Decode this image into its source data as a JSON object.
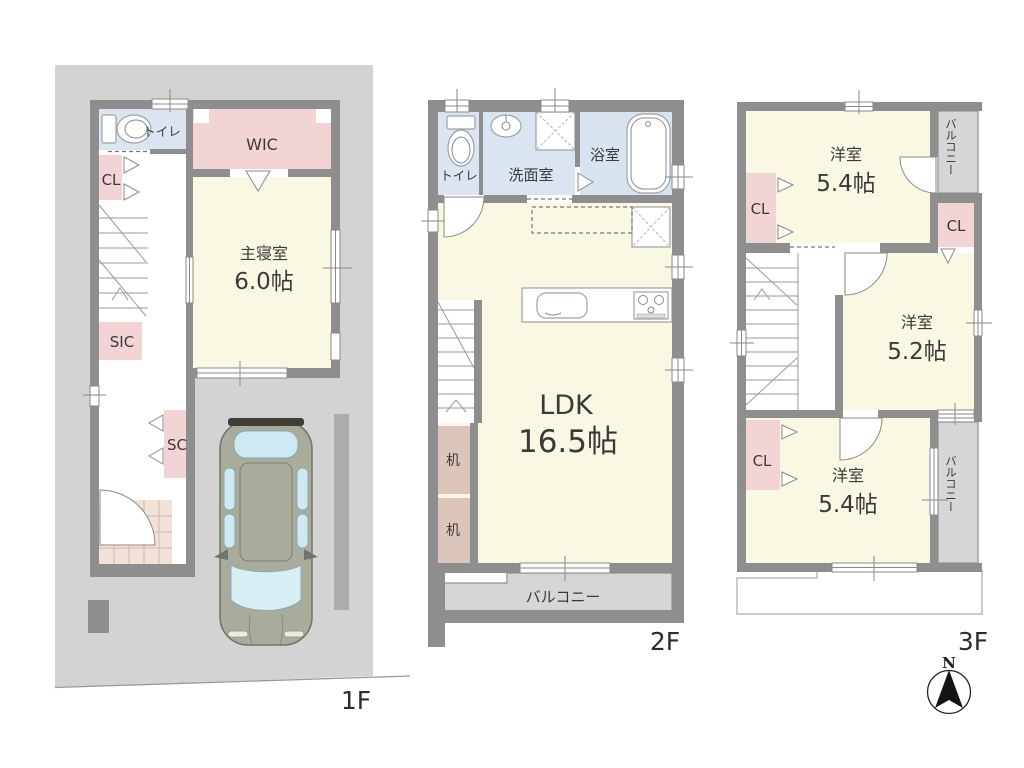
{
  "f1": {
    "floor_label": "1F",
    "toilet_label": "トイレ",
    "wic_label": "WIC",
    "cl_label": "CL",
    "bedroom_name": "主寝室",
    "bedroom_size": "6.0帖",
    "sic_label": "SIC",
    "sc_label": "SC"
  },
  "f2": {
    "floor_label": "2F",
    "toilet_label": "トイレ",
    "washroom_label": "洗面室",
    "bath_label": "浴室",
    "ldk_name": "LDK",
    "ldk_size": "16.5帖",
    "desk1_label": "机",
    "desk2_label": "机",
    "balcony_label": "バルコニー"
  },
  "f3": {
    "floor_label": "3F",
    "room_top_name": "洋室",
    "room_top_size": "5.4帖",
    "cl_top_left_label": "CL",
    "cl_top_right_label": "CL",
    "cl_bottom_left_label": "CL",
    "room_mid_name": "洋室",
    "room_mid_size": "5.2帖",
    "room_bottom_name": "洋室",
    "room_bottom_size": "5.4帖",
    "balcony_top_label": "バルコニー",
    "balcony_bottom_label": "バルコニー"
  },
  "compass": {
    "north_label": "N"
  },
  "palette": {
    "wall": "#8e8e8e",
    "site": "#d3d3d3",
    "room_cream": "#faf7e3",
    "closet_pink": "#f2d4d4",
    "desk_tan": "#dcc5ba",
    "water_blue": "#dbe5f1",
    "balcony_gray": "#d6d6d6",
    "entry_tile": "#f4e2d8",
    "car_body": "#a9ac9a",
    "car_glass": "#cfe9f2",
    "text": "#3a3a3a"
  }
}
